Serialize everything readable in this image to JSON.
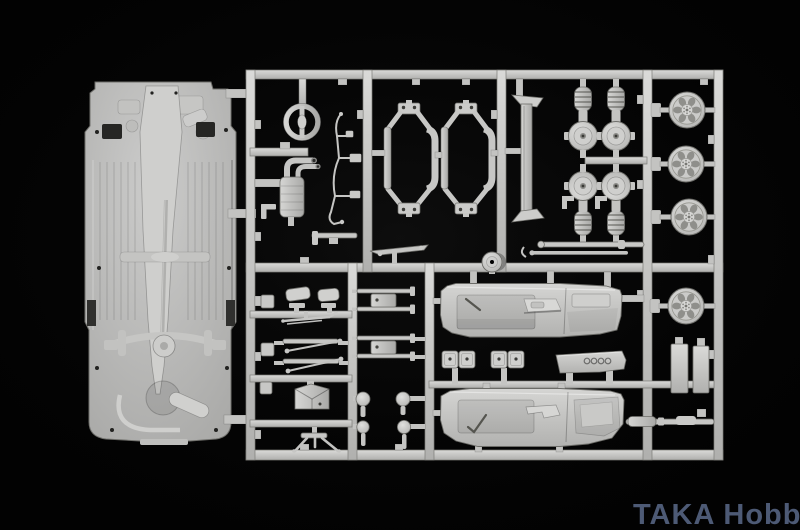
{
  "scene": {
    "type": "photograph",
    "subject": "Light-grey injection-molded plastic model car kit sprue (parts tree) photographed on a black background",
    "parts": [
      "car-chassis-plate",
      "steering-wheel",
      "exhaust-muffler",
      "brake-fuel-lines",
      "suspension-subframe-left",
      "suspension-subframe-right",
      "windshield-frame-channel",
      "coil-spring-strut",
      "brake-drum-hub",
      "axle-rods",
      "six-spoke-wheel",
      "door-panel-upper",
      "door-panel-lower",
      "seat-belt-buckles",
      "rear-parcel-shelf",
      "wing-mirror",
      "wiper-blade",
      "suspension-arms",
      "gearbox-housing",
      "jack-stand",
      "axle-set",
      "shift-knobs",
      "side-plates",
      "drive-shaft-rod",
      "fuel-filler-cap"
    ]
  },
  "watermark": {
    "text": "TAKA Hobby"
  },
  "colors": {
    "background": "#020202",
    "plastic": "#c7c7c5",
    "plastic-light": "#dedddb",
    "plastic-dark": "#a8a8a6",
    "plastic-shadow": "#7e7e7c",
    "watermark": "#4d5a75"
  }
}
